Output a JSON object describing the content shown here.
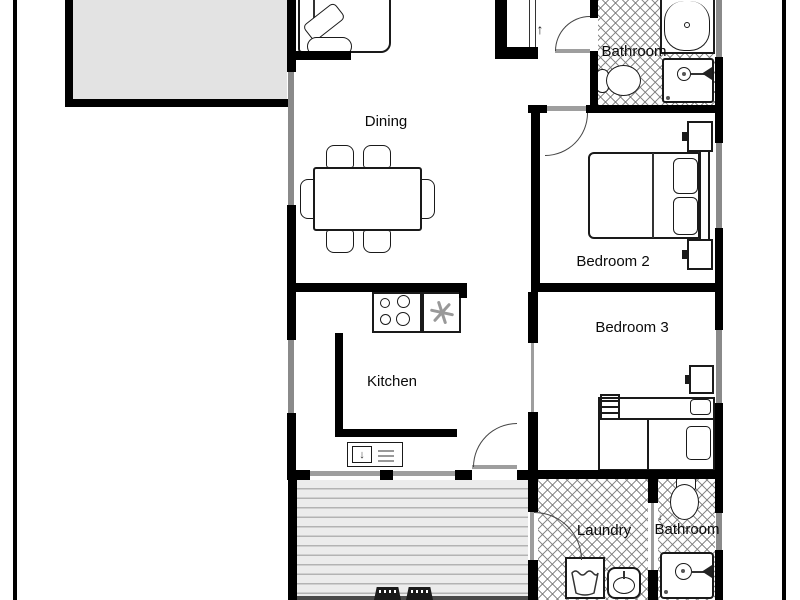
{
  "floor_plan": {
    "rooms": [
      {
        "name": "dining",
        "label": "Dining"
      },
      {
        "name": "kitchen",
        "label": "Kitchen"
      },
      {
        "name": "bedroom-2",
        "label": "Bedroom 2"
      },
      {
        "name": "bedroom-3",
        "label": "Bedroom 3"
      },
      {
        "name": "bathroom-top",
        "label": "Bathroom"
      },
      {
        "name": "laundry",
        "label": "Laundry"
      },
      {
        "name": "bathroom-bottom",
        "label": "Bathroom"
      }
    ],
    "symbols": {
      "entry_arrow": "↑",
      "door_mark": "↓",
      "cabinet_arrow": "↓"
    },
    "colors": {
      "wall": "#000000",
      "window": "#8a8a8a",
      "door_leaf": "#9e9e9e",
      "garage_fill": "#e3e3e3",
      "deck_fill": "#ececec",
      "tile_line": "#787878",
      "text": "#0a0a0a"
    },
    "fixtures": [
      "garage",
      "single-bed",
      "entry-closet",
      "dining-table",
      "dining-chairs",
      "stove",
      "extractor-fan",
      "kitchen-counter",
      "kitchen-cabinet",
      "bathtub",
      "shower",
      "toilet",
      "double-bed",
      "nightstand",
      "bunk-bed",
      "deck",
      "deck-chairs",
      "washing-machine",
      "laundry-sink"
    ]
  }
}
